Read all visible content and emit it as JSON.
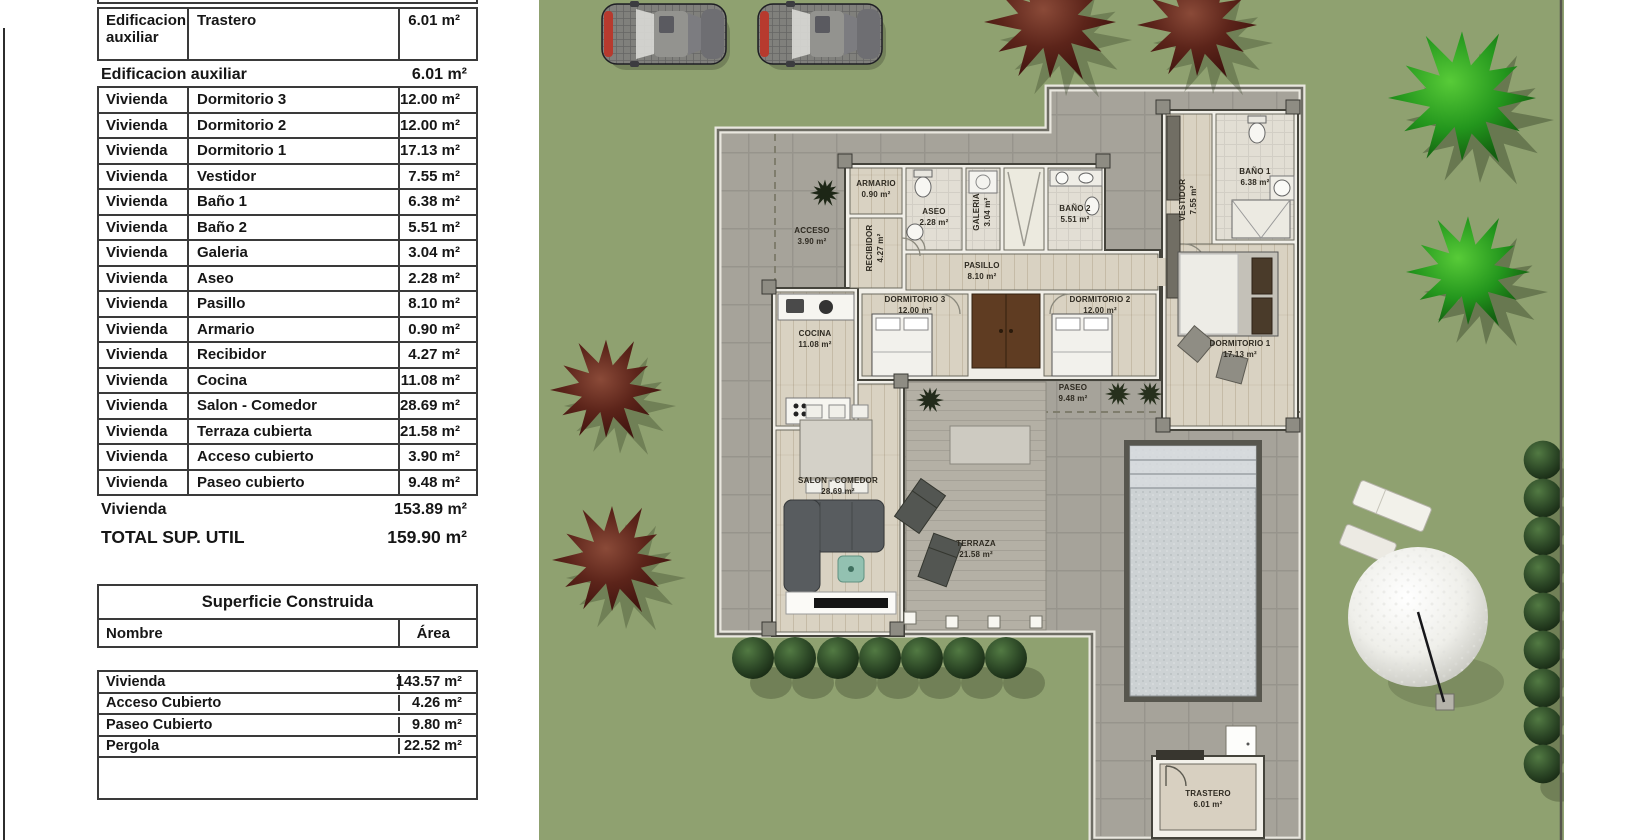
{
  "left_panel": {
    "table_superficie_util": {
      "rows": [
        {
          "group": "Edificacion auxiliar",
          "room": "Trastero",
          "area": "6.01 m²"
        },
        {
          "group": "Vivienda",
          "room": "Dormitorio 3",
          "area": "12.00 m²"
        },
        {
          "group": "Vivienda",
          "room": "Dormitorio 2",
          "area": "12.00 m²"
        },
        {
          "group": "Vivienda",
          "room": "Dormitorio 1",
          "area": "17.13 m²"
        },
        {
          "group": "Vivienda",
          "room": "Vestidor",
          "area": "7.55 m²"
        },
        {
          "group": "Vivienda",
          "room": "Baño 1",
          "area": "6.38 m²"
        },
        {
          "group": "Vivienda",
          "room": "Baño 2",
          "area": "5.51 m²"
        },
        {
          "group": "Vivienda",
          "room": "Galeria",
          "area": "3.04 m²"
        },
        {
          "group": "Vivienda",
          "room": "Aseo",
          "area": "2.28 m²"
        },
        {
          "group": "Vivienda",
          "room": "Pasillo",
          "area": "8.10 m²"
        },
        {
          "group": "Vivienda",
          "room": "Armario",
          "area": "0.90 m²"
        },
        {
          "group": "Vivienda",
          "room": "Recibidor",
          "area": "4.27 m²"
        },
        {
          "group": "Vivienda",
          "room": "Cocina",
          "area": "11.08 m²"
        },
        {
          "group": "Vivienda",
          "room": "Salon - Comedor",
          "area": "28.69 m²"
        },
        {
          "group": "Vivienda",
          "room": "Terraza cubierta",
          "area": "21.58 m²"
        },
        {
          "group": "Vivienda",
          "room": "Acceso cubierto",
          "area": "3.90 m²"
        },
        {
          "group": "Vivienda",
          "room": "Paseo cubierto",
          "area": "9.48 m²"
        }
      ],
      "subtotal_edificacion": {
        "label": "Edificacion auxiliar",
        "value": "6.01 m²"
      },
      "subtotal_vivienda": {
        "label": "Vivienda",
        "value": "153.89 m²"
      },
      "total": {
        "label": "TOTAL SUP. UTIL",
        "value": "159.90 m²"
      }
    },
    "table_superficie_construida": {
      "title": "Superficie Construida",
      "columns": {
        "name": "Nombre",
        "area": "Área"
      },
      "rows": [
        {
          "name": "Vivienda",
          "area": "143.57 m²"
        },
        {
          "name": "Acceso Cubierto",
          "area": "4.26 m²"
        },
        {
          "name": "Paseo Cubierto",
          "area": "9.80 m²"
        },
        {
          "name": "Pergola",
          "area": "22.52 m²"
        }
      ]
    }
  },
  "plan": {
    "rooms": [
      {
        "id": "acceso",
        "name": "ACCESO",
        "area": "3.90 m²"
      },
      {
        "id": "recibidor",
        "name": "RECIBIDOR",
        "area": "4.27 m²"
      },
      {
        "id": "armario",
        "name": "ARMARIO",
        "area": "0.90 m²"
      },
      {
        "id": "aseo",
        "name": "ASEO",
        "area": "2.28 m²"
      },
      {
        "id": "galeria",
        "name": "GALERIA",
        "area": "3.04 m²"
      },
      {
        "id": "bano2",
        "name": "BAÑO 2",
        "area": "5.51 m²"
      },
      {
        "id": "pasillo",
        "name": "PASILLO",
        "area": "8.10 m²"
      },
      {
        "id": "dormitorio3",
        "name": "DORMITORIO 3",
        "area": "12.00 m²"
      },
      {
        "id": "dormitorio2",
        "name": "DORMITORIO 2",
        "area": "12.00 m²"
      },
      {
        "id": "vestidor",
        "name": "VESTIDOR",
        "area": "7.55 m²"
      },
      {
        "id": "bano1",
        "name": "BAÑO 1",
        "area": "6.38 m²"
      },
      {
        "id": "dormitorio1",
        "name": "DORMITORIO 1",
        "area": "17.13 m²"
      },
      {
        "id": "cocina",
        "name": "COCINA",
        "area": "11.08 m²"
      },
      {
        "id": "salon",
        "name": "SALON - COMEDOR",
        "area": "28.69 m²"
      },
      {
        "id": "terraza",
        "name": "TERRAZA",
        "area": "21.58 m²"
      },
      {
        "id": "paseo",
        "name": "PASEO",
        "area": "9.48 m²"
      },
      {
        "id": "trastero",
        "name": "TRASTERO",
        "area": "6.01 m²"
      }
    ],
    "colors": {
      "lawn": "#8fa170",
      "paving": "#a6a39a",
      "pool_water": "#ccd1d3",
      "tree_maroon": "#5c241a",
      "tree_green": "#23961d",
      "bush": "#2c4726"
    }
  }
}
